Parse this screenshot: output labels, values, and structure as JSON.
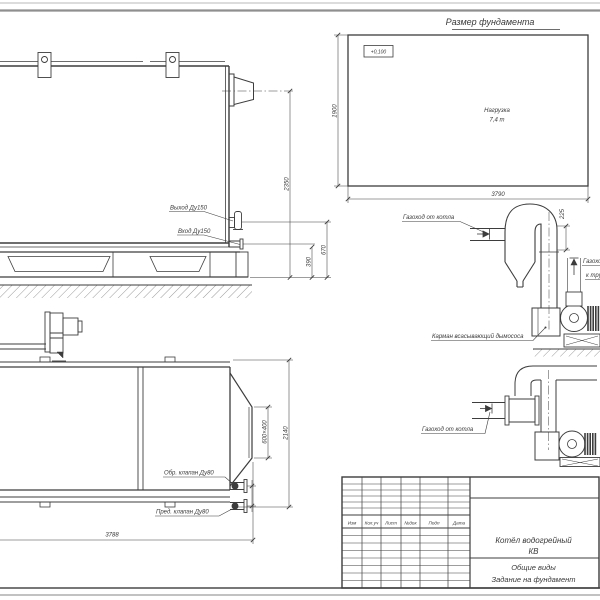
{
  "colors": {
    "line": "#3d3d3d",
    "page_background": "#ffffff",
    "frame_gray": "#909090"
  },
  "foundation": {
    "title": "Размер фундамента",
    "elevation": "+0,100",
    "load_line1": "Нагрузка",
    "load_line2": "7,4 т",
    "dim_height": "1900",
    "dim_width": "3790"
  },
  "side_view": {
    "outlet_label": "Выход Ду150",
    "inlet_label": "Вход Ду150",
    "dim_total_height": "2350",
    "dim_outlet_height": "670",
    "dim_inlet_height": "390"
  },
  "plan_view": {
    "check_valve_label": "Обр. клапан Ду80",
    "safety_valve_label": "Пред. клапан Ду80",
    "dim_length": "3788",
    "dim_width": "2140",
    "dim_outlet": "600×400"
  },
  "duct_detail_top": {
    "from_boiler_label": "Газоход от котла",
    "dim_offset": "225",
    "to_chimney_line1": "Газоход",
    "to_chimney_line2": "к трубе",
    "pocket_label": "Карман всасывающий дымососа"
  },
  "duct_detail_bottom": {
    "from_boiler_label": "Газоход от котла"
  },
  "title_block": {
    "columns": [
      "Изм",
      "Кол.уч",
      "Лист",
      "№док",
      "Подп",
      "Дата"
    ],
    "product_line1": "Котёл водогрейный",
    "product_line2": "КВ",
    "doc_line1": "Общие виды",
    "doc_line2": "Задание на фундамент"
  }
}
